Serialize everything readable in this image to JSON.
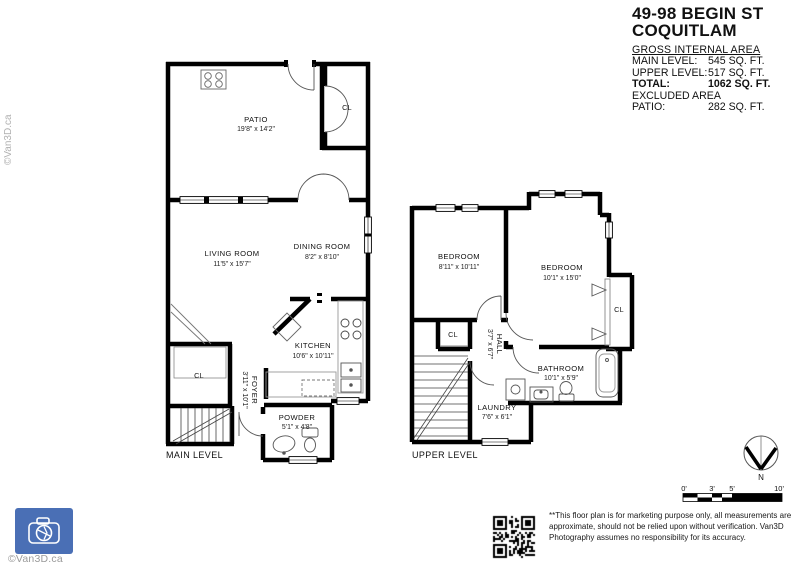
{
  "header": {
    "address_line1": "49-98 BEGIN ST",
    "address_line2": "COQUITLAM",
    "area_section_title": "GROSS INTERNAL AREA",
    "area_rows": [
      {
        "label": "MAIN LEVEL:",
        "value": "545 SQ. FT."
      },
      {
        "label": "UPPER LEVEL:",
        "value": "517 SQ. FT."
      },
      {
        "label": "TOTAL:",
        "value": "1062 SQ. FT."
      },
      {
        "label": "EXCLUDED AREA",
        "value": ""
      },
      {
        "label": "PATIO:",
        "value": "282 SQ. FT."
      }
    ]
  },
  "main_level": {
    "label": "MAIN LEVEL",
    "rooms": {
      "patio": {
        "name": "PATIO",
        "dims": "19'8\" x 14'2\""
      },
      "living": {
        "name": "LIVING ROOM",
        "dims": "11'5\" x 15'7\""
      },
      "dining": {
        "name": "DINING ROOM",
        "dims": "8'2\" x 8'10\""
      },
      "kitchen": {
        "name": "KITCHEN",
        "dims": "10'6\" x 10'11\""
      },
      "foyer": {
        "name": "FOYER",
        "dims": "3'11\" x 10'1\""
      },
      "powder": {
        "name": "POWDER",
        "dims": "5'1\" x 4'8\""
      },
      "closet": {
        "name": "CL"
      },
      "patio_closet": {
        "name": "CL"
      }
    }
  },
  "upper_level": {
    "label": "UPPER LEVEL",
    "rooms": {
      "bedroom_left": {
        "name": "BEDROOM",
        "dims": "8'11\" x 10'11\""
      },
      "bedroom_right": {
        "name": "BEDROOM",
        "dims": "10'1\" x 15'0\""
      },
      "hall": {
        "name": "HALL",
        "dims": "3'7\" x 6'7\""
      },
      "bathroom": {
        "name": "BATHROOM",
        "dims": "10'1\" x 5'9\""
      },
      "laundry": {
        "name": "LAUNDRY",
        "dims": "7'6\" x 6'1\""
      },
      "closet_hall": {
        "name": "CL"
      },
      "closet_bedroom": {
        "name": "CL"
      }
    }
  },
  "compass": {
    "label": "N"
  },
  "scale_bar": {
    "ticks": [
      "0'",
      "3'",
      "5'",
      "10'"
    ]
  },
  "footer": {
    "disclaimer_line1": "**This floor plan is for marketing purpose only, all measurements are",
    "disclaimer_line2": "approximate, should not be relied upon without verification. Van3D",
    "disclaimer_line3": "Photography assumes no responsibility for its accuracy.",
    "credit": "©Van3D.ca",
    "watermark": "©Van3D.ca"
  },
  "colors": {
    "wall": "#000000",
    "fixture_line": "#777777",
    "logo_blue": "#4a6fb5",
    "credit_gray": "#9b9b9b"
  }
}
